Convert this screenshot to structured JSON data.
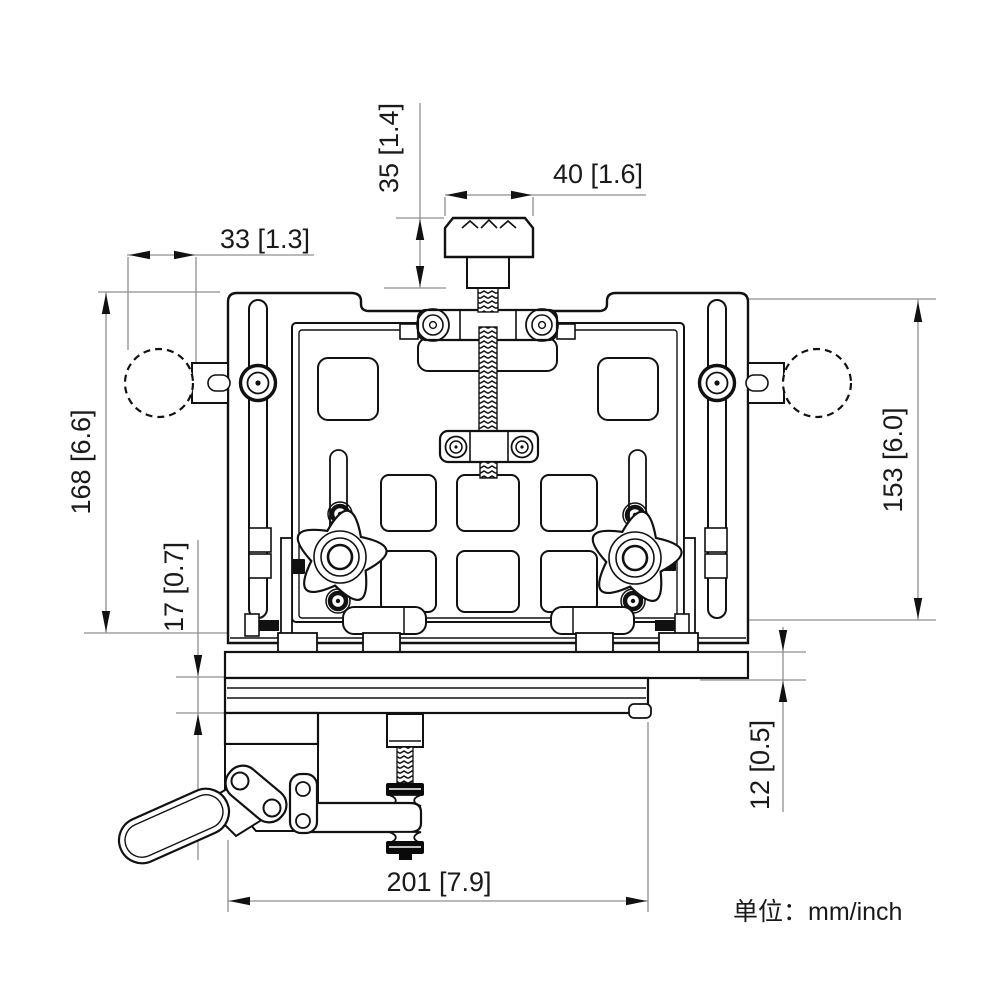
{
  "figure": {
    "type": "mechanical-dimension-drawing",
    "units_note": "单位：mm/inch"
  },
  "dimensions": {
    "knob_height": {
      "label": "35 [1.4]",
      "mm": 35,
      "inch": 1.4
    },
    "knob_width": {
      "label": "40 [1.6]",
      "mm": 40,
      "inch": 1.6
    },
    "ball_diameter": {
      "label": "33 [1.3]",
      "mm": 33,
      "inch": 1.3
    },
    "overall_height": {
      "label": "168 [6.6]",
      "mm": 168,
      "inch": 6.6
    },
    "rail_thickness": {
      "label": "17 [0.7]",
      "mm": 17,
      "inch": 0.7
    },
    "frame_height": {
      "label": "153 [6.0]",
      "mm": 153,
      "inch": 6.0
    },
    "plate_thickness": {
      "label": "12 [0.5]",
      "mm": 12,
      "inch": 0.5
    },
    "base_width": {
      "label": "201 [7.9]",
      "mm": 201,
      "inch": 7.9
    }
  },
  "colors": {
    "line": "#111111",
    "dim_line": "#8f8f8f",
    "text": "#1a1a1a"
  }
}
